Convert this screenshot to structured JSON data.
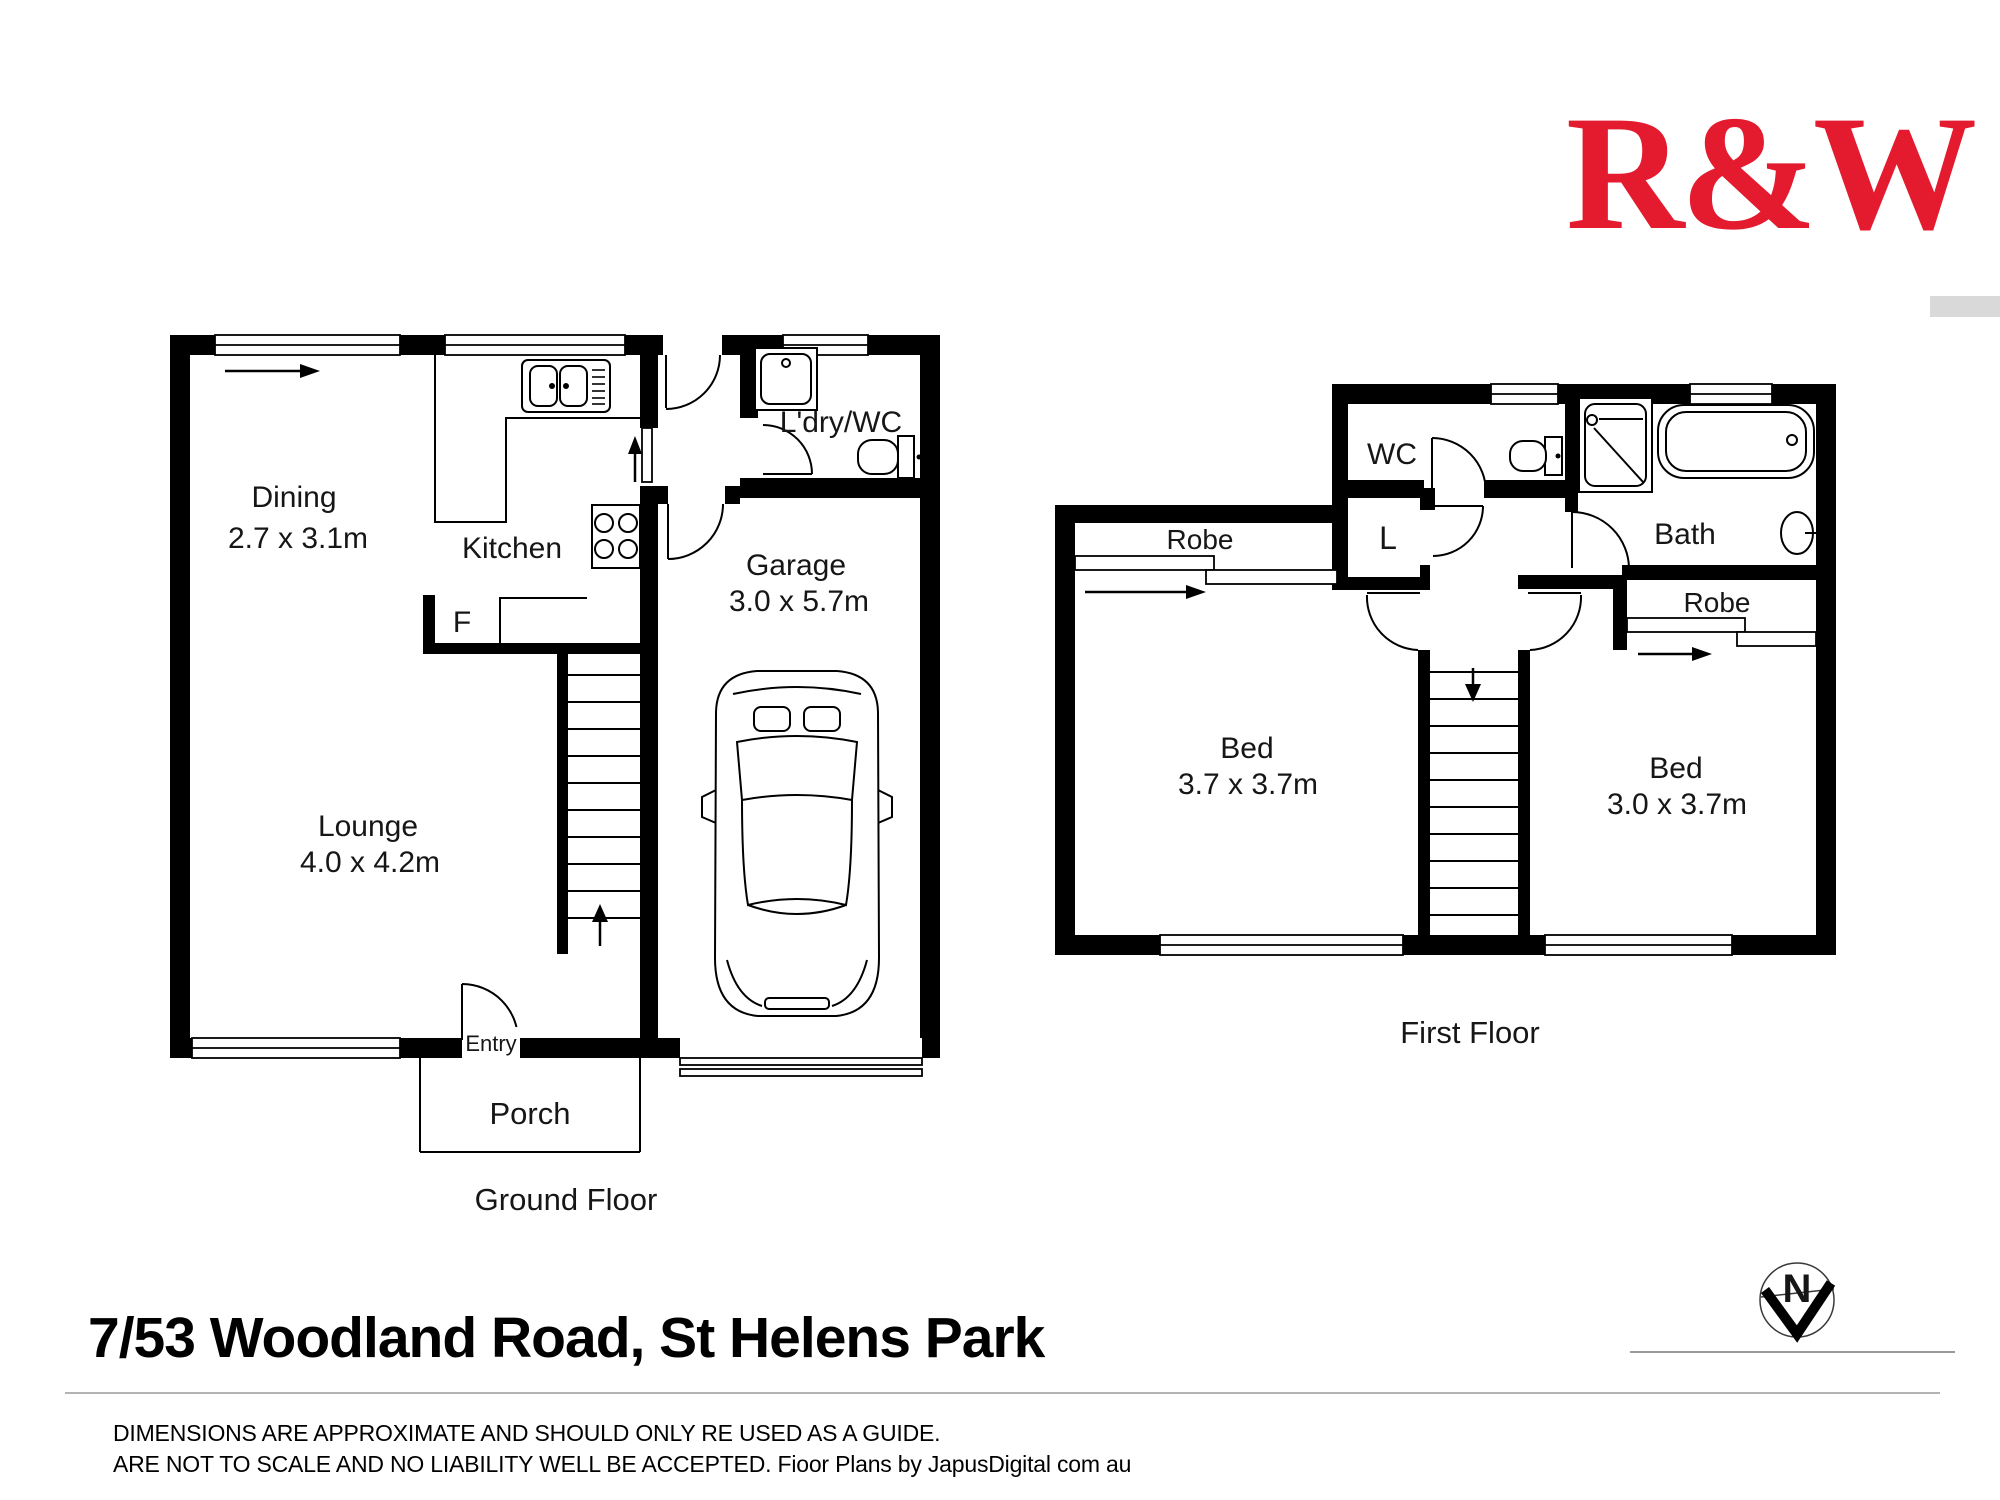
{
  "logo": {
    "text": "R&W",
    "color": "#e41b2f"
  },
  "plans": {
    "ground": {
      "title": "Ground Floor",
      "dining_name": "Dining",
      "dining_dims": "2.7 x 3.1m",
      "kitchen_name": "Kitchen",
      "fridge": "F",
      "laundry_name": "L'dry/WC",
      "garage_name": "Garage",
      "garage_dims": "3.0 x 5.7m",
      "lounge_name": "Lounge",
      "lounge_dims": "4.0 x 4.2m",
      "entry": "Entry",
      "porch": "Porch"
    },
    "first": {
      "title": "First Floor",
      "wc": "WC",
      "linen": "L",
      "bath": "Bath",
      "robe_left": "Robe",
      "robe_right": "Robe",
      "bed1_name": "Bed",
      "bed1_dims": "3.7 x 3.7m",
      "bed2_name": "Bed",
      "bed2_dims": "3.0 x 3.7m"
    }
  },
  "address": "7/53 Woodland Road, St Helens Park",
  "disclaimer": {
    "line1": "DIMENSIONS ARE APPROXIMATE AND SHOULD ONLY RE USED AS A GUIDE.",
    "line2": "ARE NOT TO SCALE AND NO LIABILITY WELL BE ACCEPTED. Fioor Plans by JapusDigital com au"
  },
  "compass": {
    "north": "N"
  }
}
